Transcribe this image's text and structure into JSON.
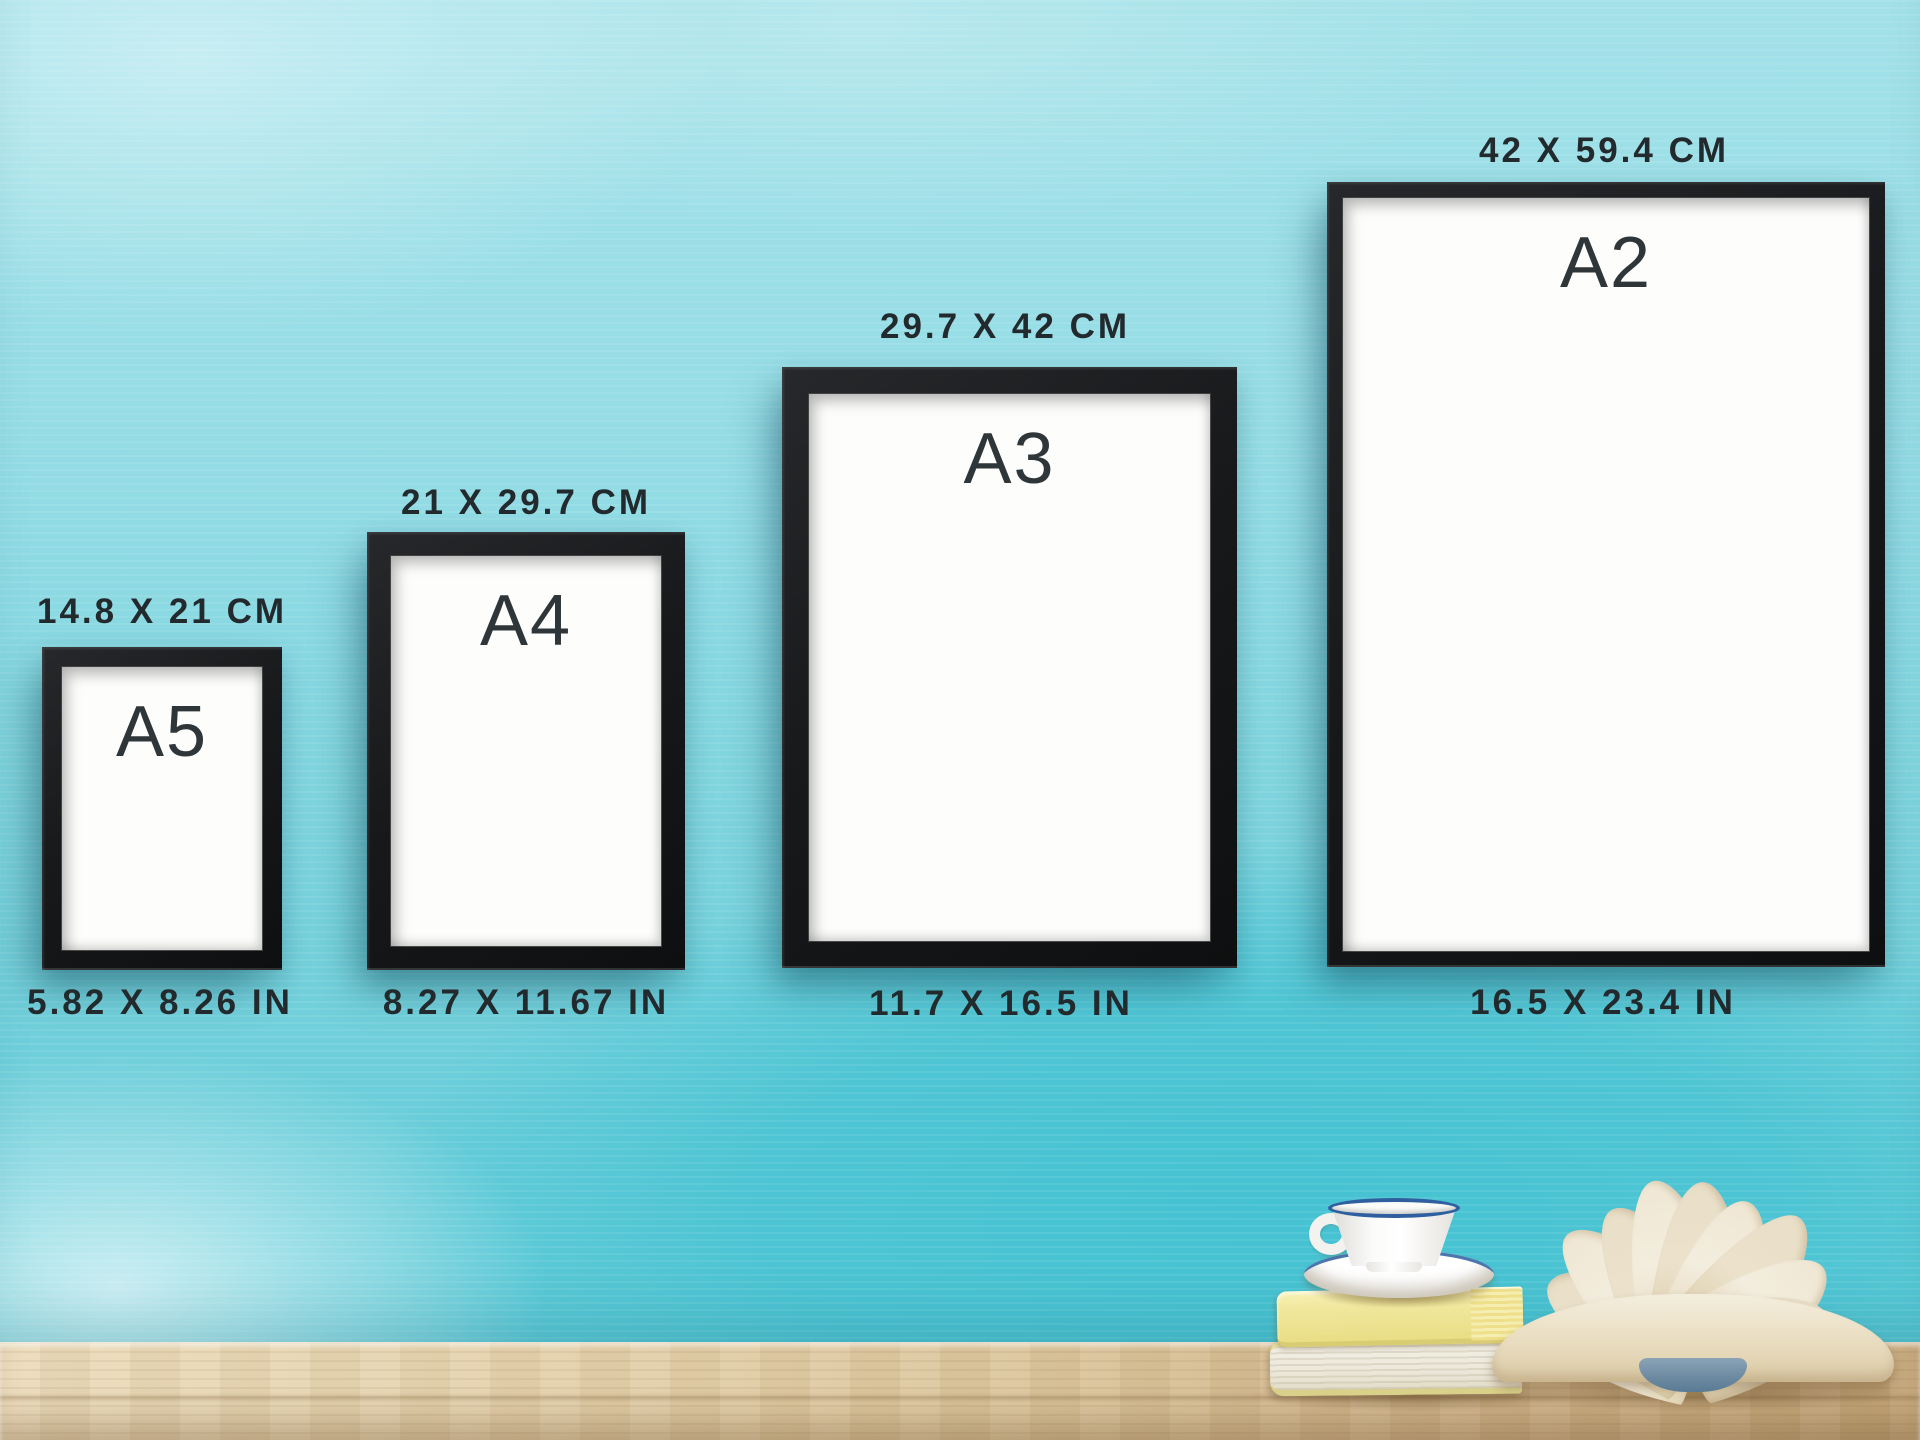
{
  "scene": {
    "description": "A-series poster frame size comparison on a turquoise painted wall above a wooden table"
  },
  "frames": [
    {
      "label": "A5",
      "cm": "14.8 X 21 CM",
      "inches": "5.82 X 8.26 IN"
    },
    {
      "label": "A4",
      "cm": "21 X 29.7 CM",
      "inches": "8.27 X 11.67 IN"
    },
    {
      "label": "A3",
      "cm": "29.7 X 42 CM",
      "inches": "11.7 X 16.5 IN"
    },
    {
      "label": "A2",
      "cm": "42 X 59.4 CM",
      "inches": "16.5 X 23.4 IN"
    }
  ],
  "props": [
    "coffee-cup-with-blue-stripe",
    "saucer",
    "stack-of-two-books",
    "open-book-with-fanned-pages"
  ],
  "colors": {
    "wall_light": "#a3e1e8",
    "wall_deep": "#45c2d2",
    "frame_black": "#17191b",
    "paper_white": "#fdfdfc",
    "label_text": "#222a2d",
    "table_wood": "#dbc59c",
    "cup_stripe_blue": "#2f5f9e",
    "book_yellow": "#f0e79c",
    "open_book_spine_blue": "#6d8ba3"
  }
}
